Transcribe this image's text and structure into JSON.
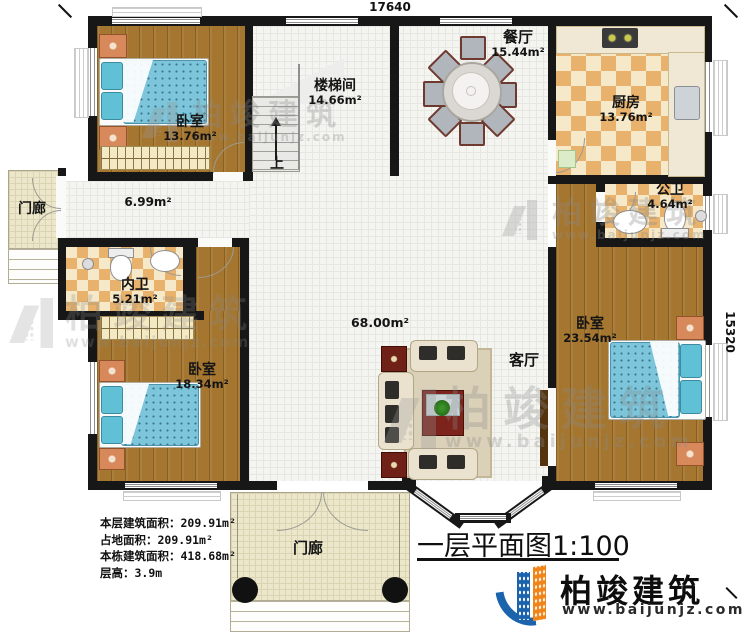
{
  "plan": {
    "dimensions": {
      "top": "17640",
      "right": "15320"
    },
    "rooms": {
      "bedroom1": {
        "name": "卧室",
        "area": "13.76m²"
      },
      "stairwell": {
        "name": "楼梯间",
        "area": "14.66m²"
      },
      "dining": {
        "name": "餐厅",
        "area": "15.44m²"
      },
      "kitchen": {
        "name": "厨房",
        "area": "13.76m²"
      },
      "public_bath": {
        "name": "公卫",
        "area": "4.64m²"
      },
      "inner_bath": {
        "name": "内卫",
        "area": "5.21m²"
      },
      "bedroom2": {
        "name": "卧室",
        "area": "18.34m²"
      },
      "bedroom3": {
        "name": "卧室",
        "area": "23.54m²"
      },
      "living": {
        "name": "客厅",
        "area": "68.00m²"
      },
      "hallway": {
        "area": "6.99m²"
      },
      "porch_left": {
        "name": "门廊"
      },
      "porch_bottom": {
        "name": "门廊"
      }
    },
    "annotations": {
      "stairs_up": "上"
    }
  },
  "stats": {
    "rows": [
      {
        "label": "本层建筑面积：",
        "value": "209.91m²"
      },
      {
        "label": "占地面积：",
        "value": "209.91m²"
      },
      {
        "label": "本栋建筑面积：",
        "value": "418.68m²"
      },
      {
        "label": "层高：",
        "value": "3.9m"
      }
    ]
  },
  "title": {
    "text": "一层平面图",
    "scale": "1:100"
  },
  "brand": {
    "name": "柏竣建筑",
    "website": "www.baijunjz.com"
  },
  "watermark": {
    "name": "柏竣建筑",
    "website": "www.baijunjz.com"
  },
  "colors": {
    "wall": "#171717",
    "wood_floor": "#a5762f",
    "checker_tile": "#e8b26c",
    "bed_blue": "#7cc5da",
    "brand_blue": "#1b63ad",
    "brand_orange": "#f08419"
  }
}
